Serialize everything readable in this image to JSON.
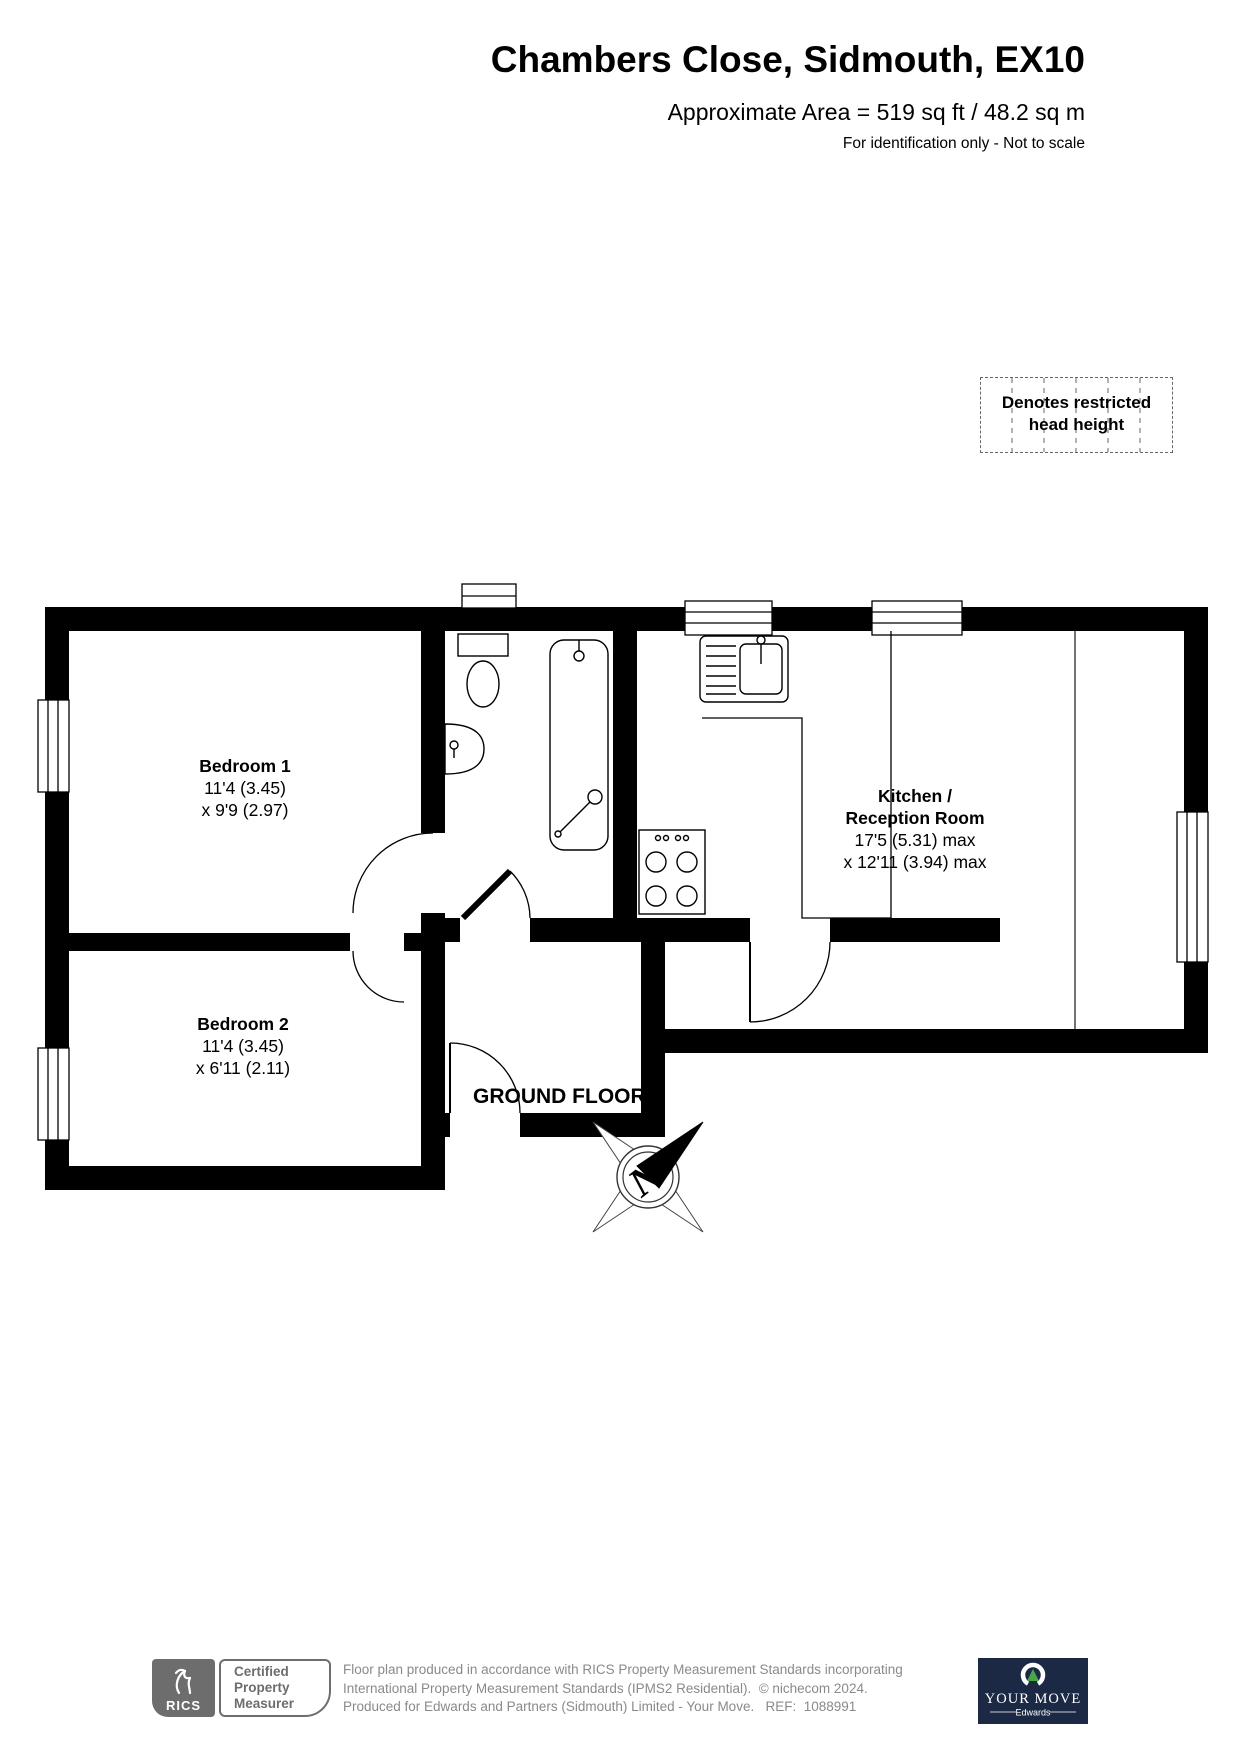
{
  "header": {
    "title": "Chambers Close, Sidmouth, EX10",
    "area": "Approximate Area = 519 sq ft / 48.2 sq m",
    "note": "For identification only - Not to scale"
  },
  "legend": {
    "line1": "Denotes restricted",
    "line2": "head height"
  },
  "plan": {
    "floor_label": "GROUND FLOOR",
    "compass_letter": "N",
    "rooms": {
      "bedroom1": {
        "name": "Bedroom 1",
        "dims1": "11'4 (3.45)",
        "dims2": "x 9'9 (2.97)"
      },
      "bedroom2": {
        "name": "Bedroom 2",
        "dims1": "11'4 (3.45)",
        "dims2": "x 6'11 (2.11)"
      },
      "kitchen": {
        "name1": "Kitchen /",
        "name2": "Reception Room",
        "dims1": "17'5 (5.31) max",
        "dims2": "x 12'11 (3.94) max"
      }
    }
  },
  "footer": {
    "rics_brand": "RICS",
    "badge": {
      "line1": "Certified",
      "line2": "Property",
      "line3": "Measurer"
    },
    "disclaimer": {
      "line1": "Floor plan produced in accordance with RICS Property Measurement Standards incorporating",
      "line2": "International Property Measurement Standards (IPMS2 Residential).  © nichecom 2024.",
      "line3": "Produced for Edwards and Partners (Sidmouth) Limited - Your Move.   REF:  1088991"
    },
    "yourmove": {
      "brand": "YOUR MOVE",
      "sub": "Edwards"
    }
  },
  "colors": {
    "wall": "#000000",
    "text_gray": "#8a8a8a",
    "badge_gray": "#6d6d6d",
    "navy": "#1c2945",
    "green": "#4aa546"
  }
}
